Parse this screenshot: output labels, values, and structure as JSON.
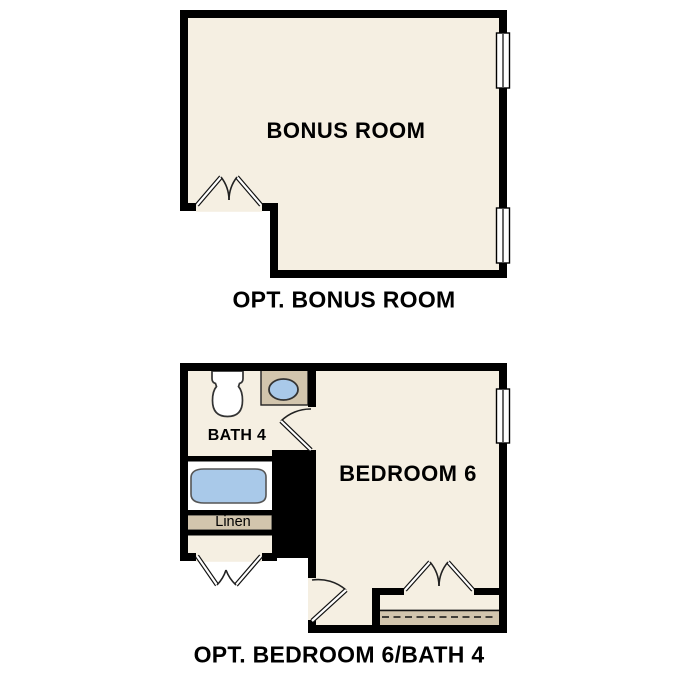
{
  "colors": {
    "background": "#ffffff",
    "floor_cream": "#f5efe2",
    "counter_tan": "#d2c5ad",
    "fixture_blue": "#a9c9e9",
    "wall_black": "#000000",
    "outline_gray": "#555555"
  },
  "plan_bonus": {
    "caption": "OPT. BONUS ROOM",
    "room_label": "BONUS ROOM",
    "window_count": 2,
    "door_type": "double-door"
  },
  "plan_bed_bath": {
    "caption": "OPT. BEDROOM 6/BATH 4",
    "bedroom_label": "BEDROOM 6",
    "bath_label": "BATH 4",
    "linen_label": "Linen",
    "window_count": 1,
    "fixtures": [
      "toilet",
      "sink",
      "bathtub",
      "linen-closet",
      "closet-rod"
    ]
  }
}
